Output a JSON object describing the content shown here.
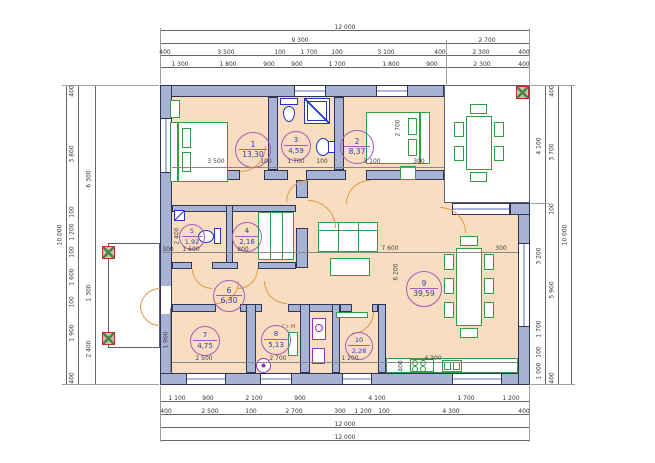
{
  "drawing": {
    "type": "architectural-floor-plan",
    "rooms": [
      {
        "num": "1",
        "area": "13,30"
      },
      {
        "num": "2",
        "area": "8,37"
      },
      {
        "num": "3",
        "area": "4,59"
      },
      {
        "num": "4",
        "area": "2,16"
      },
      {
        "num": "5",
        "area": "1,92"
      },
      {
        "num": "6",
        "area": "6,30"
      },
      {
        "num": "7",
        "area": "4,75"
      },
      {
        "num": "8",
        "area": "5,13"
      },
      {
        "num": "9",
        "area": "39,59"
      },
      {
        "num": "10",
        "area": "2,28"
      }
    ],
    "labels": {
      "washing_machine": "Ст.М"
    },
    "dimensions": {
      "top": {
        "row_total": [
          "12 000"
        ],
        "row_major": [
          "9 300",
          "2 700"
        ],
        "row_walls": [
          "400",
          "3 500",
          "100",
          "1 700",
          "100",
          "3 100",
          "400",
          "2 300",
          "400"
        ],
        "row_detail": [
          "1 300",
          "1 800",
          "900",
          "900",
          "1 700",
          "1 800",
          "900",
          "2 300",
          "400"
        ]
      },
      "bottom": {
        "row_detail": [
          "1 100",
          "900",
          "2 100",
          "900",
          "4 100",
          "1 700",
          "1 200"
        ],
        "row_walls": [
          "400",
          "2 500",
          "100",
          "2 700",
          "300",
          "1 200",
          "100",
          "4 300",
          "400"
        ],
        "row_total1": [
          "12 000"
        ],
        "row_total2": [
          "12 000"
        ]
      },
      "left": {
        "col_total": [
          "10 000"
        ],
        "col_walls": [
          "400",
          "3 800",
          "100",
          "1 200",
          "100",
          "1 600",
          "100",
          "1 900",
          "400"
        ],
        "col_inner": [
          "6 300",
          "1 300",
          "2 400"
        ]
      },
      "right": {
        "col_inner": [
          "4 100",
          "3 200",
          "1 700",
          "100",
          "1 000"
        ],
        "col_walls": [
          "400",
          "3 700",
          "100",
          "5 900",
          "400"
        ],
        "col_total": [
          "10 000"
        ]
      },
      "interior": [
        "3 500",
        "100",
        "1 700",
        "100",
        "3 100",
        "300",
        "2 700",
        "7 600",
        "6 200",
        "300",
        "300",
        "1 600",
        "800",
        "2 400",
        "2 500",
        "2 700",
        "1 200",
        "4 300",
        "1 900",
        "400"
      ]
    },
    "colors": {
      "wall_fill": "#a8b2d4",
      "floor": "#f8ddc0",
      "furniture": "#2f9e44",
      "sanitary": "#2433c8",
      "door": "#e09a4a",
      "room_tag": "#a85ab8",
      "column": "#c03028"
    }
  }
}
